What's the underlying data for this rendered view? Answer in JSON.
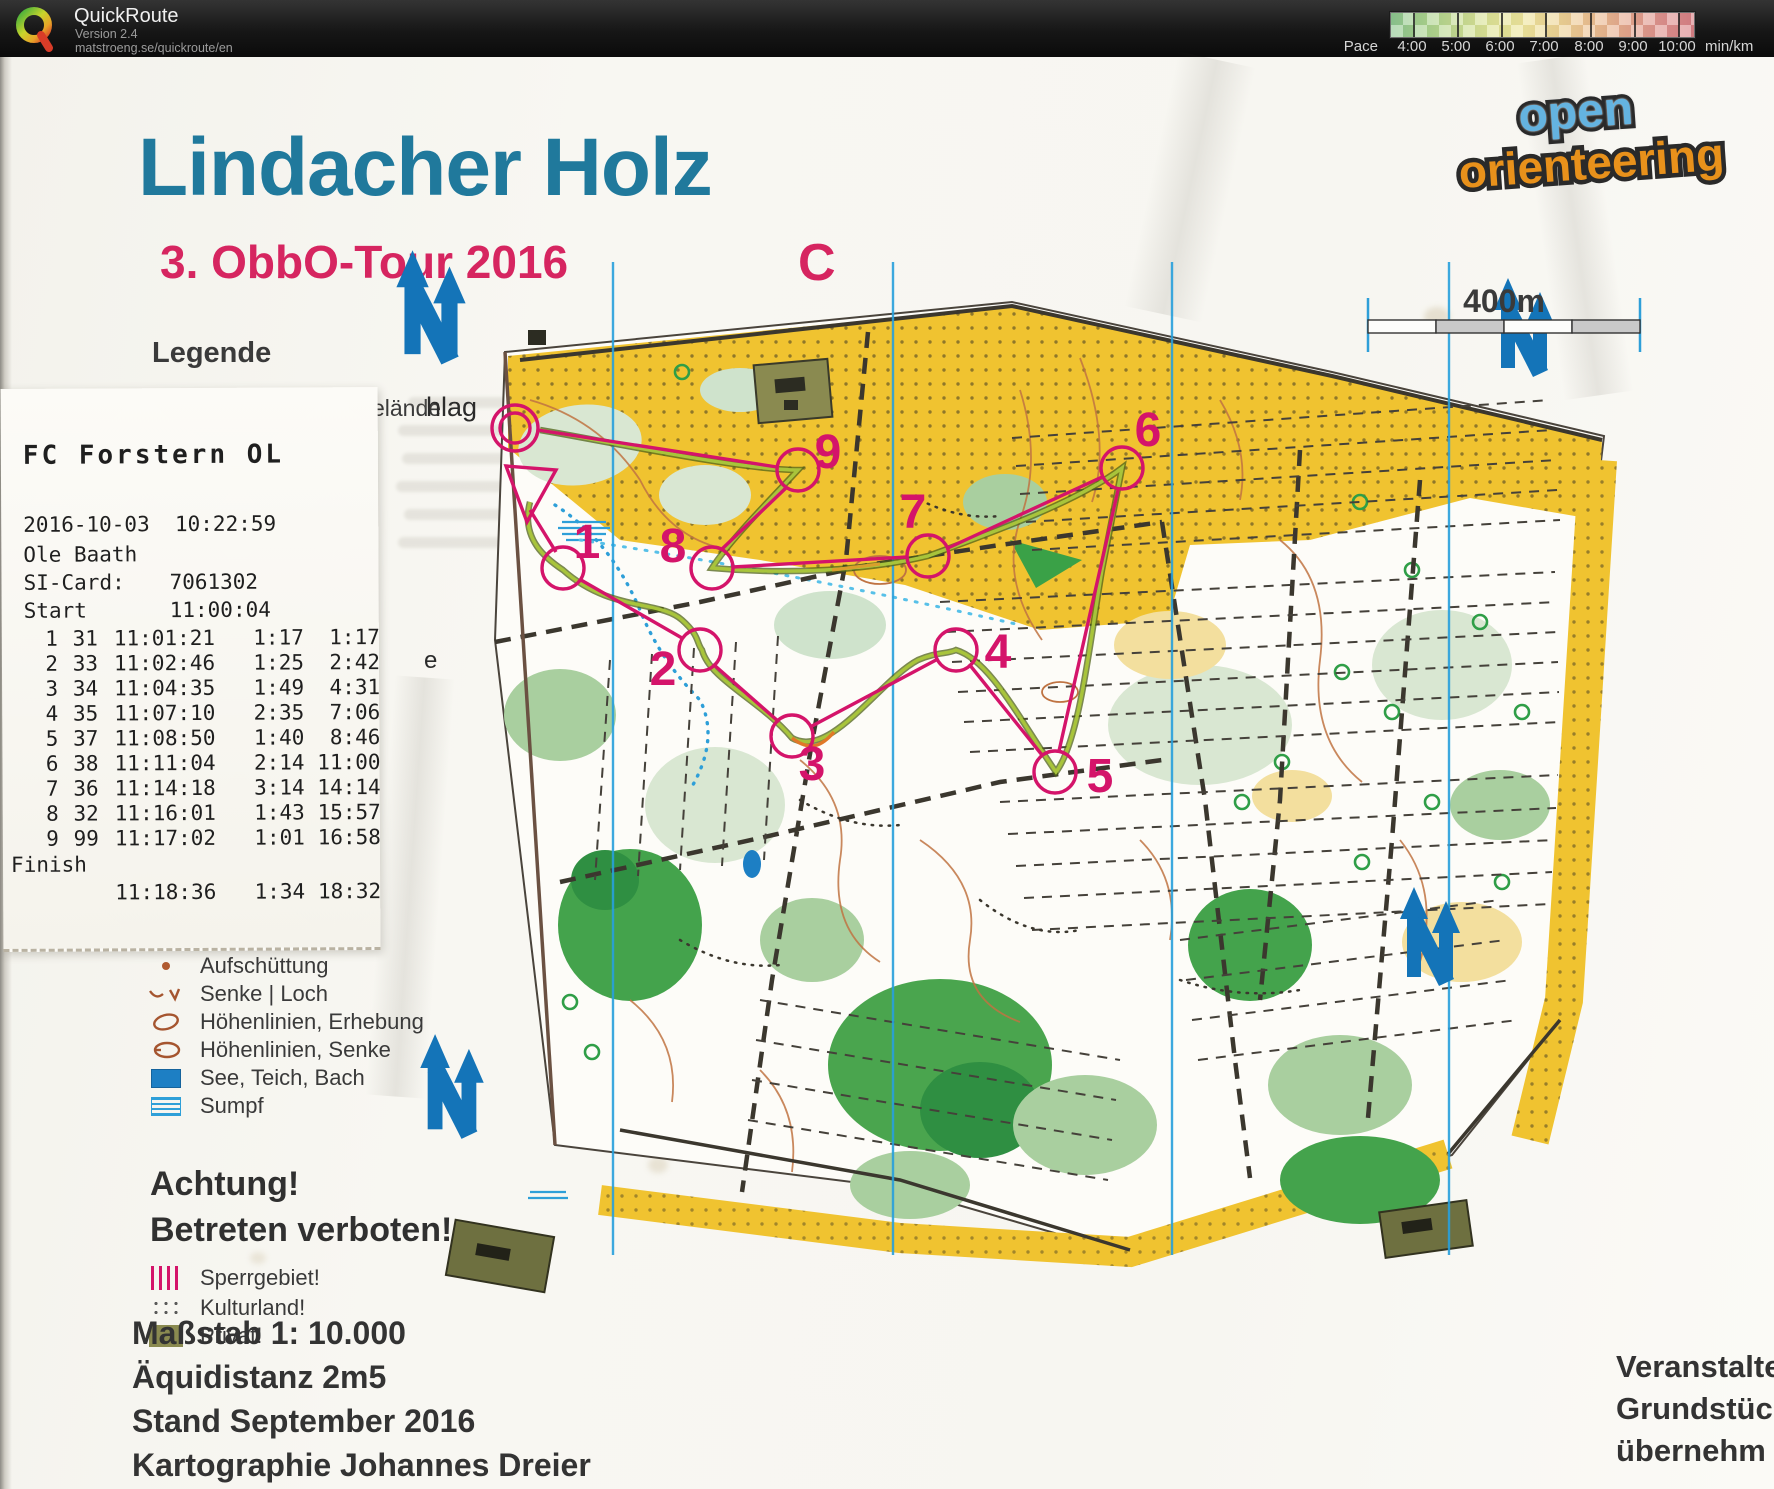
{
  "header": {
    "app_name": "QuickRoute",
    "version": "Version 2.4",
    "url": "matstroeng.se/quickroute/en",
    "pace": {
      "label": "Pace",
      "unit": "min/km",
      "ticks": [
        "4:00",
        "5:00",
        "6:00",
        "7:00",
        "8:00",
        "9:00",
        "10:00"
      ]
    }
  },
  "map_titles": {
    "title": "Lindacher Holz",
    "subtitle": "3. ObbO-Tour 2016",
    "course_letter": "C",
    "logo_word1": "open",
    "logo_word2": "orienteering",
    "scale_label": "400m",
    "margin_label_1": "hlag",
    "margin_label_2": "e"
  },
  "legend": {
    "heading": "Legende",
    "first_item": "Wiese, offenes Gelände",
    "items": [
      {
        "label": "Aufschüttung"
      },
      {
        "label": "Senke | Loch"
      },
      {
        "label": "Höhenlinien, Erhebung"
      },
      {
        "label": "Höhenlinien, Senke"
      },
      {
        "label": "See, Teich, Bach"
      },
      {
        "label": "Sumpf"
      }
    ],
    "warning_heading_1": "Achtung!",
    "warning_heading_2": "Betreten verboten!",
    "warning_items": [
      "Sperrgebiet!",
      "Kulturland!",
      "Privat!"
    ]
  },
  "splits": {
    "club": "FC Forstern OL",
    "datetime": "2016-10-03  10:22:59",
    "runner": "Ole Baath",
    "si_card_label": "SI-Card:",
    "si_card": "7061302",
    "start_label": "Start",
    "start_time": "11:00:04",
    "rows": [
      {
        "n": "1",
        "code": "31",
        "time": "11:01:21",
        "split": "1:17",
        "total": "1:17"
      },
      {
        "n": "2",
        "code": "33",
        "time": "11:02:46",
        "split": "1:25",
        "total": "2:42"
      },
      {
        "n": "3",
        "code": "34",
        "time": "11:04:35",
        "split": "1:49",
        "total": "4:31"
      },
      {
        "n": "4",
        "code": "35",
        "time": "11:07:10",
        "split": "2:35",
        "total": "7:06"
      },
      {
        "n": "5",
        "code": "37",
        "time": "11:08:50",
        "split": "1:40",
        "total": "8:46"
      },
      {
        "n": "6",
        "code": "38",
        "time": "11:11:04",
        "split": "2:14",
        "total": "11:00"
      },
      {
        "n": "7",
        "code": "36",
        "time": "11:14:18",
        "split": "3:14",
        "total": "14:14"
      },
      {
        "n": "8",
        "code": "32",
        "time": "11:16:01",
        "split": "1:43",
        "total": "15:57"
      },
      {
        "n": "9",
        "code": "99",
        "time": "11:17:02",
        "split": "1:01",
        "total": "16:58"
      }
    ],
    "finish_label": "Finish",
    "finish_time": "11:18:36",
    "finish_split": "1:34",
    "finish_total": "18:32"
  },
  "map_info": {
    "lines": [
      "Maßstab 1: 10.000",
      "Äquidistanz 2m5",
      "Stand September 2016",
      "Kartographie Johannes Dreier"
    ]
  },
  "organizer_info": {
    "lines": [
      "Veranstalte",
      "Grundstüc",
      "übernehm"
    ]
  },
  "course": {
    "controls": [
      {
        "n": "1"
      },
      {
        "n": "2"
      },
      {
        "n": "3"
      },
      {
        "n": "4"
      },
      {
        "n": "5"
      },
      {
        "n": "6"
      },
      {
        "n": "7"
      },
      {
        "n": "8"
      },
      {
        "n": "9"
      }
    ]
  }
}
